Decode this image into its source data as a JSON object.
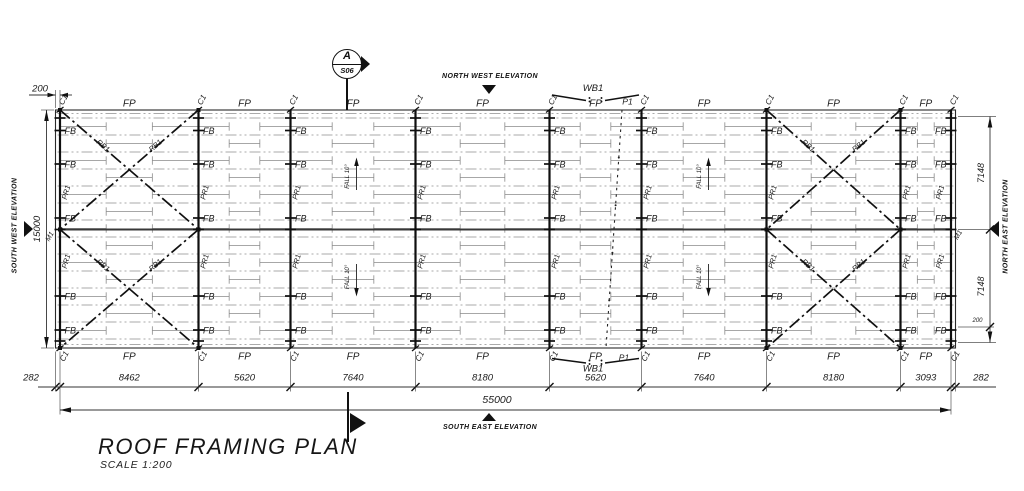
{
  "drawing": {
    "title": "ROOF FRAMING PLAN",
    "scale": "SCALE 1:200",
    "section_marker": {
      "letter": "A",
      "sheet": "S06"
    },
    "elevations": {
      "north_west": "NORTH WEST ELEVATION",
      "south_east": "SOUTH EAST ELEVATION",
      "south_west": "SOUTH WEST ELEVATION",
      "north_east": "NORTH EAST ELEVATION"
    },
    "member_labels": {
      "fascia_purlin": "FP",
      "column": "C1",
      "fly_brace": "FB",
      "purlin": "PR1",
      "roof_brace": "RB1",
      "wind_brace": "WB1",
      "prop": "P1",
      "mullion": "M1",
      "fall": "FALL 10°"
    },
    "dimensions": {
      "top_offset": "200",
      "left_overall": "15000",
      "right_half_upper": "7148",
      "right_half_lower": "7148",
      "right_offset": "200",
      "bottom_segments": [
        "282",
        "8462",
        "5620",
        "7640",
        "8180",
        "5620",
        "7640",
        "8180",
        "3093",
        "282"
      ],
      "bottom_overall": "55000"
    }
  },
  "geometry": {
    "plan": {
      "left": 55.5,
      "top": 110,
      "right": 955.5,
      "bottom": 348,
      "ridge": 229.5
    },
    "grid_x": [
      60,
      198.5,
      290.5,
      415.5,
      549.5,
      641.5,
      766.5,
      900.5,
      951
    ],
    "stations": [
      55.5,
      60,
      198.5,
      290.5,
      415.5,
      549.5,
      641.5,
      766.5,
      900.5,
      951,
      955.5
    ],
    "purlin_first_y": 118,
    "purlin_step": 17,
    "purlin_count": 14,
    "brick_first_y": 126.5,
    "brick_count": 13,
    "fb_rows": [
      130.5,
      164,
      218,
      296,
      330
    ],
    "pr_rows": [
      193,
      262
    ],
    "tick_rows": [
      118,
      130.5,
      164,
      218,
      229.5,
      296,
      330,
      341
    ],
    "brace_bays": [
      0,
      6
    ],
    "wb_bay": 4,
    "fall_x": [
      352,
      704
    ],
    "dim": {
      "bottom_text_y": 380.5,
      "bottom_line_y": 387,
      "overall_line_y": 410,
      "overall_text_x": 497,
      "overall_text_y": 403,
      "left_line_x": 46.5,
      "right_line_x": 990,
      "right_ext_rows": [
        116.5,
        229.5,
        342.5
      ]
    }
  }
}
